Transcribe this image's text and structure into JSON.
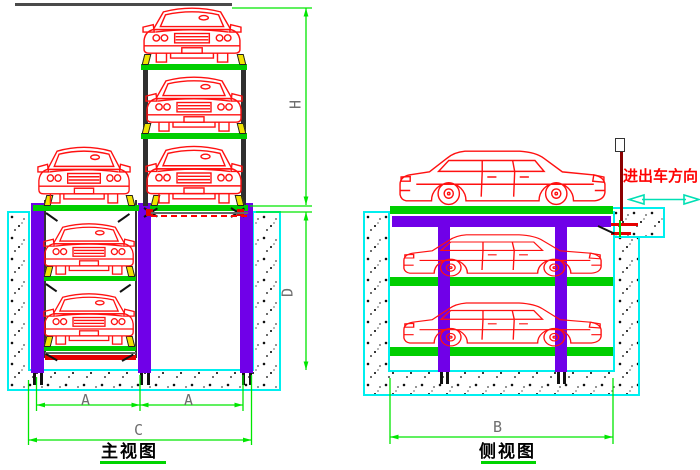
{
  "front_view": {
    "title": "主视图",
    "dim_h": "H",
    "dim_d": "D",
    "dim_a1": "A",
    "dim_a2": "A",
    "dim_c": "C"
  },
  "side_view": {
    "title": "侧视图",
    "dim_b": "B",
    "direction_label": "进出车方向"
  },
  "icons": {
    "direction_arrow": "double-headed-horizontal-arrow"
  },
  "colors": {
    "car_outline": "#ff1111",
    "platform_green": "#00ce00",
    "column_purple": "#7000e8",
    "pit_wall_border_cyan": "#00efef",
    "dimension_green": "#00e600",
    "bracket_yellow": "#f0e300",
    "direction_text_red": "#ff0000",
    "antenna_dark_red": "#8b0000"
  }
}
